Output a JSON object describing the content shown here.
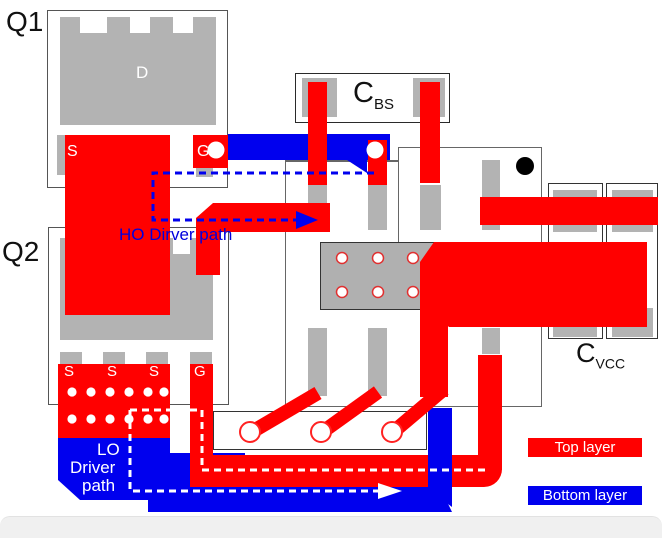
{
  "figure": {
    "title": "Half-bridge gate driver PCB layout",
    "components": {
      "q1": {
        "label": "Q1",
        "drain": "D",
        "source": "S",
        "gate": "G"
      },
      "q2": {
        "label": "Q2",
        "pads": [
          "S",
          "S",
          "S",
          "G"
        ]
      },
      "cbs": {
        "main": "C",
        "sub": "BS"
      },
      "cvcc": {
        "main": "C",
        "sub": "VCC"
      }
    },
    "annotations": {
      "ho_path": "HO Dirver path",
      "lo_path": {
        "line1": "LO",
        "line2": "Driver",
        "line3": "path"
      }
    },
    "legend": {
      "top": "Top layer",
      "bottom": "Bottom layer"
    },
    "colors": {
      "top_layer": "#ff0000",
      "bottom_layer": "#0000ee",
      "pad_gray": "#b3b3b3"
    }
  }
}
